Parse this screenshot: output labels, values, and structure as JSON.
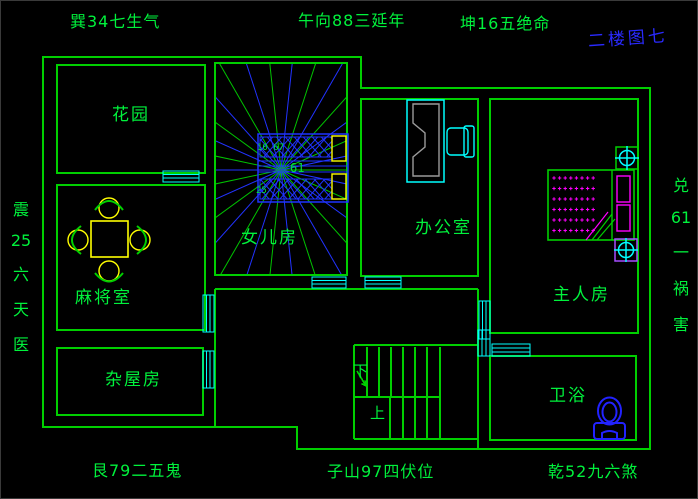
{
  "labels": {
    "top_left": "巽34七生气",
    "top_center": "午向88三延年",
    "top_right": "坤16五绝命",
    "floor_title": "二楼图七",
    "bottom_left": "艮79二五鬼",
    "bottom_center": "子山97四伏位",
    "bottom_right": "乾52九六煞"
  },
  "side_left": [
    "震",
    "25",
    "六",
    "天",
    "医"
  ],
  "side_right": [
    "兑",
    "61",
    "一",
    "祸",
    "害"
  ],
  "rooms": {
    "garden": "花园",
    "daughter": "女儿房",
    "office": "办公室",
    "mahjong": "麻将室",
    "master": "主人房",
    "storage": "杂屋房",
    "bath": "卫浴"
  },
  "stairs": {
    "down": "下",
    "up": "上"
  },
  "compass": {
    "num_top": "10 67",
    "num_center": "61",
    "num_bottom": "25"
  },
  "icons": [
    "luopan-compass-icon",
    "stairs-icon",
    "bed-icon",
    "pillow-icon",
    "light-fixture-icon",
    "toilet-icon",
    "mahjong-table-icon",
    "chair-icon",
    "desk-icon",
    "window-icon",
    "door-icon"
  ],
  "colors": {
    "background": "#000000",
    "wall_green": "#00cf00",
    "text_green": "#00f23c",
    "cyan": "#00ffff",
    "blue": "#2233ff",
    "yellow": "#ffff00",
    "magenta": "#ff00ff",
    "violet": "#a64dff",
    "gray": "#9a9a9a",
    "title_blue": "#2a2aff"
  }
}
